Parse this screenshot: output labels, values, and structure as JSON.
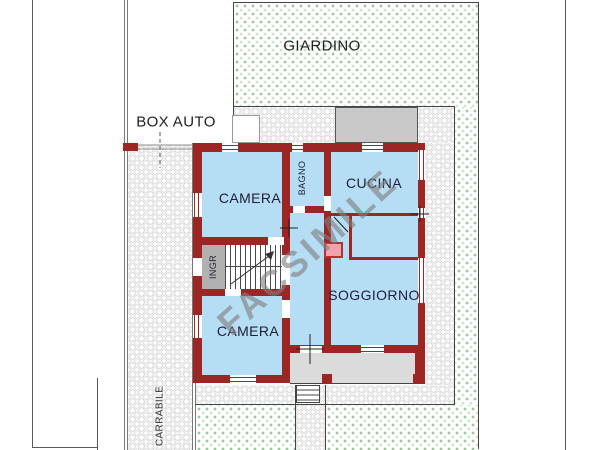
{
  "floorplan": {
    "watermark": "FACSIMILE",
    "outdoor_labels": {
      "garden": "GIARDINO",
      "garage": "BOX AUTO",
      "driveway": "CARRABILE"
    },
    "room_labels": {
      "bedroom_top": "CAMERA",
      "bathroom": "BAGNO",
      "kitchen": "CUCINA",
      "living_room": "SOGGIORNO",
      "bedroom_bottom": "CAMERA",
      "entrance": "INGR"
    },
    "colors": {
      "wall": "#9B2623",
      "room_fill": "#B5DDF4",
      "garden_dot": "#9CC89C",
      "terrace": "#C9C9C9",
      "portico": "#DBDBDB",
      "ingresso": "#B1B1B1",
      "highlight": "#F2A2AA",
      "watermark": "#808080",
      "label": "#20203A"
    }
  }
}
